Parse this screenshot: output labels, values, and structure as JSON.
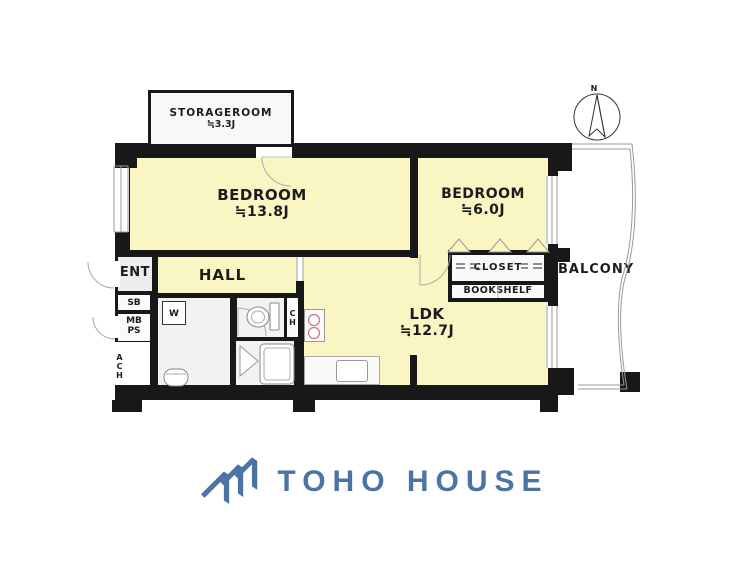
{
  "plan": {
    "north_label": "N",
    "rooms": {
      "storageroom": {
        "label": "STORAGEROOM",
        "size": "≒3.3J"
      },
      "bedroom_main": {
        "label": "BEDROOM",
        "size": "≒13.8J"
      },
      "bedroom_second": {
        "label": "BEDROOM",
        "size": "≒6.0J"
      },
      "ldk": {
        "label": "LDK",
        "size": "≒12.7J"
      },
      "hall": {
        "label": "HALL"
      },
      "entrance": {
        "label": "ENT"
      },
      "balcony": {
        "label": "BALCONY"
      },
      "closet": {
        "label": "CLOSET"
      },
      "bookshelf": {
        "label": "BOOKSHELF"
      }
    },
    "fixtures": {
      "shoe_box": "SB",
      "meter_box_line1": "MB",
      "meter_box_line2": "PS",
      "ach": "ACH",
      "washer": "W",
      "ch": "CH"
    }
  },
  "branding": {
    "company": "TOHO HOUSE"
  },
  "colors": {
    "room_yellow": "#FAF6C4",
    "wall": "#181818",
    "logo_blue": "#4B73A5",
    "burner": "#CC7777"
  }
}
